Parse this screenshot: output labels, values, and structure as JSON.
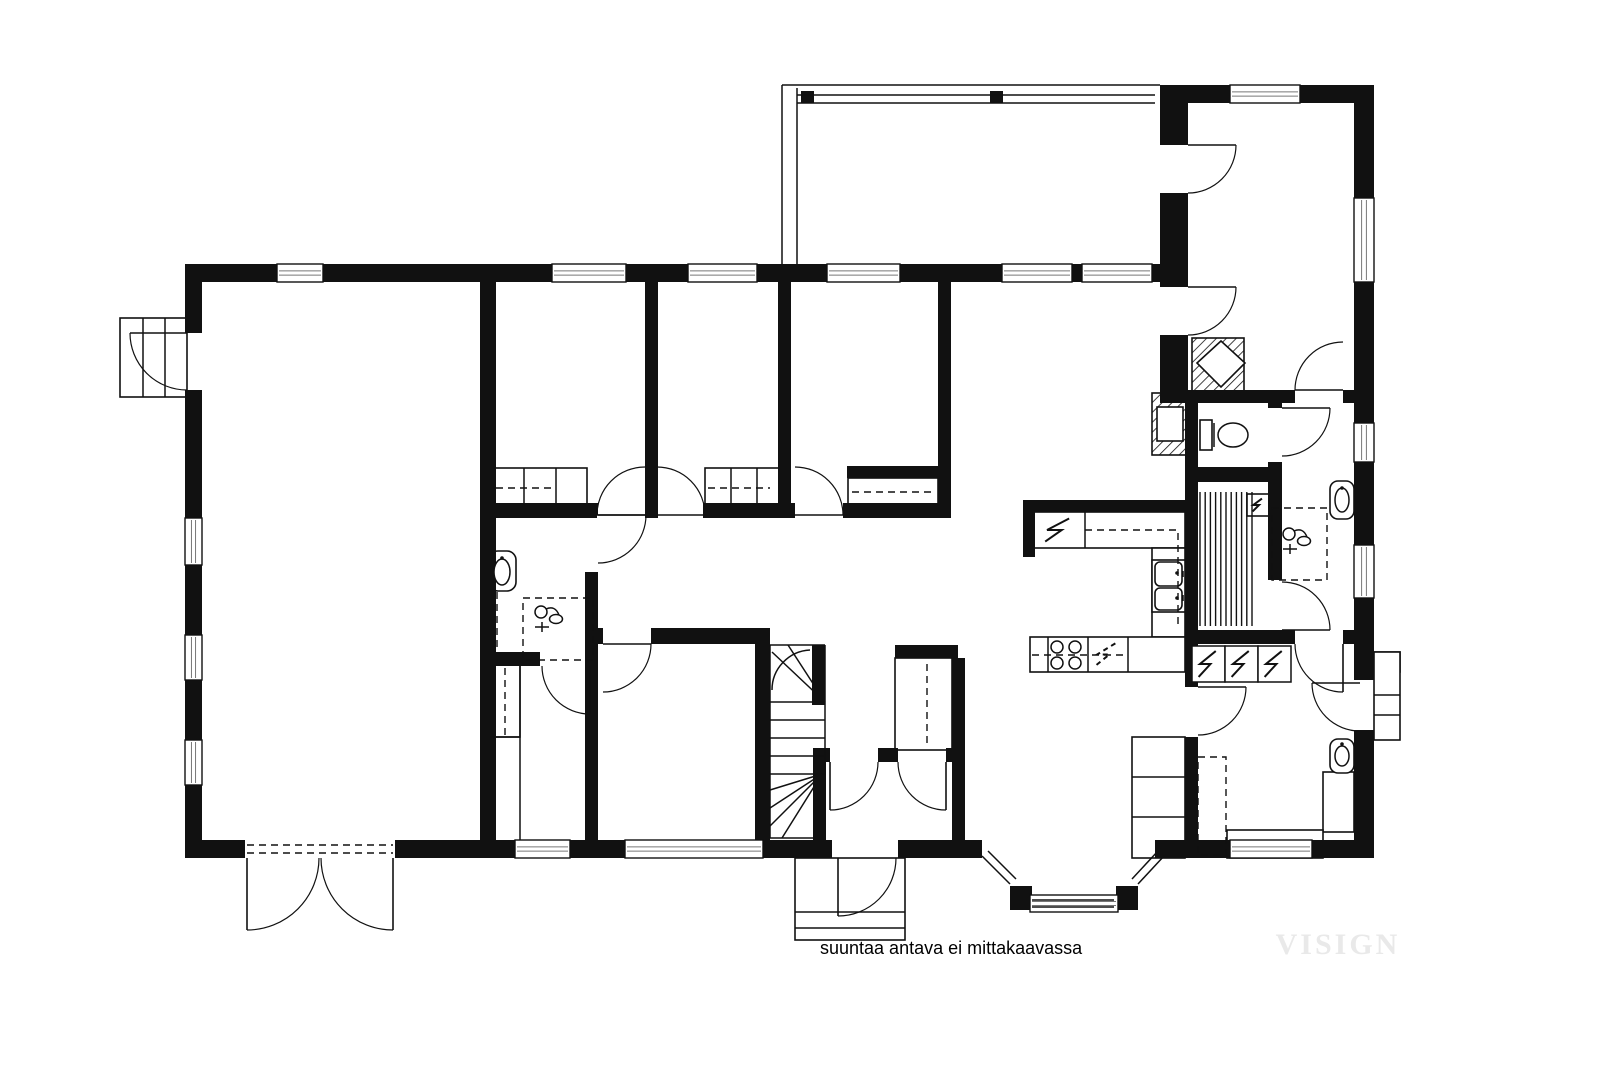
{
  "caption": {
    "text": "suuntaa antava ei mittakaavassa"
  },
  "watermark": {
    "text": "VISIGN"
  },
  "colors": {
    "ink": "#111111",
    "glass": "#777777",
    "gray_bar": "#999999",
    "watermark": "#e9e9e9",
    "bg": "#ffffff"
  },
  "canvas": {
    "width": 1600,
    "height": 1067
  },
  "plan": {
    "walls": [
      [
        185,
        264,
        92,
        18
      ],
      [
        323,
        264,
        229,
        18
      ],
      [
        626,
        264,
        62,
        18
      ],
      [
        757,
        264,
        70,
        18
      ],
      [
        900,
        264,
        102,
        18
      ],
      [
        1072,
        264,
        10,
        18
      ],
      [
        1152,
        264,
        36,
        18
      ],
      [
        1160,
        85,
        70,
        18
      ],
      [
        1300,
        85,
        74,
        18
      ],
      [
        185,
        264,
        17,
        69
      ],
      [
        185,
        390,
        17,
        128
      ],
      [
        185,
        565,
        17,
        70
      ],
      [
        185,
        680,
        17,
        60
      ],
      [
        185,
        785,
        17,
        73
      ],
      [
        185,
        840,
        60,
        18
      ],
      [
        395,
        840,
        120,
        18
      ],
      [
        570,
        840,
        55,
        18
      ],
      [
        763,
        840,
        69,
        18
      ],
      [
        898,
        840,
        84,
        18
      ],
      [
        1155,
        840,
        75,
        18
      ],
      [
        1312,
        840,
        62,
        18
      ],
      [
        1354,
        85,
        20,
        113
      ],
      [
        1354,
        282,
        20,
        141
      ],
      [
        1354,
        462,
        20,
        83
      ],
      [
        1354,
        598,
        20,
        82
      ],
      [
        1354,
        730,
        20,
        128
      ],
      [
        1160,
        85,
        28,
        60
      ],
      [
        1160,
        193,
        28,
        94
      ],
      [
        1160,
        335,
        28,
        68
      ],
      [
        1185,
        395,
        13,
        292
      ],
      [
        1185,
        737,
        13,
        121
      ],
      [
        1188,
        390,
        107,
        13
      ],
      [
        1343,
        390,
        31,
        13
      ],
      [
        1268,
        390,
        14,
        18
      ],
      [
        1268,
        462,
        14,
        18
      ],
      [
        1198,
        467,
        84,
        15
      ],
      [
        1268,
        480,
        14,
        100
      ],
      [
        1198,
        630,
        70,
        14
      ],
      [
        1268,
        630,
        27,
        14
      ],
      [
        1343,
        630,
        31,
        14
      ],
      [
        480,
        282,
        16,
        576
      ],
      [
        645,
        282,
        13,
        236
      ],
      [
        778,
        282,
        13,
        236
      ],
      [
        938,
        282,
        13,
        236
      ],
      [
        480,
        503,
        117,
        15
      ],
      [
        645,
        503,
        12,
        15
      ],
      [
        703,
        503,
        92,
        15
      ],
      [
        843,
        503,
        108,
        15
      ],
      [
        847,
        466,
        93,
        12
      ],
      [
        585,
        503,
        13,
        12
      ],
      [
        585,
        572,
        13,
        83
      ],
      [
        480,
        652,
        60,
        14
      ],
      [
        590,
        652,
        8,
        14
      ],
      [
        585,
        652,
        13,
        206
      ],
      [
        598,
        628,
        5,
        16
      ],
      [
        651,
        628,
        117,
        16
      ],
      [
        755,
        628,
        15,
        230
      ],
      [
        812,
        645,
        13,
        60
      ],
      [
        813,
        748,
        13,
        110
      ],
      [
        895,
        645,
        63,
        13
      ],
      [
        952,
        658,
        13,
        200
      ],
      [
        822,
        748,
        8,
        14
      ],
      [
        878,
        748,
        20,
        14
      ],
      [
        946,
        748,
        12,
        14
      ],
      [
        1023,
        500,
        165,
        12
      ],
      [
        1023,
        500,
        12,
        57
      ],
      [
        801,
        91,
        13,
        12
      ],
      [
        990,
        91,
        13,
        12
      ],
      [
        1010,
        886,
        22,
        24
      ],
      [
        1116,
        886,
        22,
        24
      ]
    ],
    "windows": [
      [
        277,
        264,
        46,
        18,
        "h"
      ],
      [
        552,
        264,
        74,
        18,
        "h"
      ],
      [
        688,
        264,
        69,
        18,
        "h"
      ],
      [
        827,
        264,
        73,
        18,
        "h"
      ],
      [
        1002,
        264,
        70,
        18,
        "h"
      ],
      [
        1082,
        264,
        70,
        18,
        "h"
      ],
      [
        1230,
        85,
        70,
        18,
        "h"
      ],
      [
        515,
        840,
        55,
        18,
        "h"
      ],
      [
        625,
        840,
        138,
        18,
        "h"
      ],
      [
        1230,
        840,
        82,
        18,
        "h"
      ],
      [
        185,
        518,
        17,
        47,
        "v"
      ],
      [
        185,
        635,
        17,
        45,
        "v"
      ],
      [
        185,
        740,
        17,
        45,
        "v"
      ],
      [
        1354,
        198,
        20,
        84,
        "v"
      ],
      [
        1354,
        423,
        20,
        39,
        "v"
      ],
      [
        1354,
        545,
        20,
        53,
        "v"
      ],
      [
        1030,
        895,
        88,
        17,
        "h"
      ]
    ],
    "doors": [
      [
        187,
        333,
        130,
        333,
        187,
        390,
        0
      ],
      [
        247,
        858,
        247,
        930,
        319,
        858,
        0
      ],
      [
        393,
        858,
        393,
        930,
        321,
        858,
        1
      ],
      [
        838,
        858,
        838,
        916,
        896,
        858,
        0
      ],
      [
        830,
        762,
        830,
        810,
        878,
        762,
        0
      ],
      [
        946,
        762,
        946,
        810,
        898,
        762,
        1
      ],
      [
        590,
        666,
        590,
        714,
        542,
        666,
        1
      ],
      [
        598,
        515,
        646,
        515,
        598,
        563,
        1
      ],
      [
        645,
        515,
        597,
        515,
        645,
        467,
        1
      ],
      [
        657,
        515,
        705,
        515,
        657,
        467,
        0
      ],
      [
        795,
        515,
        843,
        515,
        795,
        467,
        0
      ],
      [
        603,
        644,
        651,
        644,
        603,
        692,
        1
      ],
      [
        1188,
        145,
        1236,
        145,
        1188,
        193,
        1
      ],
      [
        1188,
        287,
        1236,
        287,
        1188,
        335,
        1
      ],
      [
        1343,
        390,
        1295,
        390,
        1343,
        342,
        1
      ],
      [
        1282,
        408,
        1330,
        408,
        1282,
        456,
        1
      ],
      [
        1282,
        630,
        1330,
        630,
        1282,
        582,
        0
      ],
      [
        1198,
        687,
        1246,
        687,
        1198,
        735,
        1
      ],
      [
        1343,
        644,
        1343,
        692,
        1295,
        644,
        1
      ],
      [
        1360,
        683,
        1312,
        683,
        1360,
        731,
        0
      ]
    ],
    "rects": [
      [
        120,
        318,
        67,
        79
      ],
      [
        795,
        858,
        110,
        82
      ],
      [
        1374,
        652,
        26,
        88
      ],
      [
        492,
        468,
        95,
        37
      ],
      [
        705,
        468,
        77,
        37
      ],
      [
        848,
        478,
        90,
        28
      ],
      [
        490,
        665,
        30,
        72
      ],
      [
        895,
        658,
        57,
        92
      ],
      [
        1028,
        512,
        157,
        36
      ],
      [
        1152,
        548,
        33,
        89
      ],
      [
        1030,
        637,
        155,
        35
      ],
      [
        1132,
        737,
        53,
        121
      ],
      [
        1323,
        772,
        31,
        60
      ],
      [
        1227,
        830,
        96,
        28
      ],
      [
        1152,
        560,
        33,
        52
      ],
      [
        1157,
        407,
        26,
        34
      ],
      [
        1200,
        420,
        12,
        30
      ],
      [
        1247,
        494,
        22,
        22
      ]
    ],
    "roundrects": [
      [
        489,
        551,
        27,
        40,
        9
      ],
      [
        1330,
        481,
        24,
        38,
        8
      ],
      [
        1330,
        739,
        24,
        34,
        8
      ],
      [
        1155,
        562,
        27,
        24,
        5
      ],
      [
        1155,
        588,
        27,
        22,
        5
      ]
    ],
    "polys": [
      [
        1197,
        363,
        1221,
        341,
        1245,
        363,
        1221,
        387
      ]
    ],
    "hatches": [
      [
        1192,
        338,
        52,
        54
      ],
      [
        1152,
        393,
        38,
        62
      ],
      [
        1374,
        652,
        26,
        20
      ]
    ],
    "lines": [
      [
        782,
        85,
        1160,
        85
      ],
      [
        782,
        85,
        782,
        264
      ],
      [
        797,
        88,
        797,
        264
      ],
      [
        797,
        95,
        1155,
        95
      ],
      [
        797,
        103,
        1155,
        103
      ],
      [
        143,
        318,
        143,
        397
      ],
      [
        165,
        318,
        165,
        397
      ],
      [
        795,
        912,
        905,
        912
      ],
      [
        795,
        928,
        905,
        928
      ],
      [
        1374,
        695,
        1400,
        695
      ],
      [
        1374,
        715,
        1400,
        715
      ],
      [
        524,
        468,
        524,
        505
      ],
      [
        556,
        468,
        556,
        505
      ],
      [
        731,
        468,
        731,
        505
      ],
      [
        757,
        468,
        757,
        505
      ],
      [
        520,
        665,
        520,
        840
      ],
      [
        490,
        737,
        520,
        737
      ],
      [
        1085,
        512,
        1085,
        548
      ],
      [
        1048,
        637,
        1048,
        672
      ],
      [
        1088,
        637,
        1088,
        672
      ],
      [
        1128,
        637,
        1128,
        672
      ],
      [
        1132,
        777,
        1185,
        777
      ],
      [
        1132,
        817,
        1185,
        817
      ],
      [
        1032,
        900,
        1114,
        900
      ],
      [
        1032,
        907,
        1114,
        907
      ],
      [
        982,
        856,
        1010,
        884
      ],
      [
        988,
        851,
        1016,
        879
      ],
      [
        1138,
        884,
        1164,
        856
      ],
      [
        1132,
        879,
        1158,
        851
      ],
      [
        770,
        645,
        825,
        645
      ],
      [
        770,
        645,
        770,
        838
      ],
      [
        825,
        645,
        825,
        775
      ],
      [
        825,
        702,
        772,
        652
      ],
      [
        825,
        702,
        788,
        645
      ],
      [
        770,
        702,
        825,
        702
      ],
      [
        770,
        720,
        825,
        720
      ],
      [
        770,
        738,
        825,
        738
      ],
      [
        770,
        756,
        825,
        756
      ],
      [
        770,
        774,
        825,
        774
      ],
      [
        822,
        774,
        770,
        790
      ],
      [
        822,
        774,
        770,
        808
      ],
      [
        822,
        774,
        770,
        826
      ],
      [
        822,
        774,
        782,
        838
      ],
      [
        770,
        838,
        815,
        838
      ],
      [
        1214,
        423,
        1214,
        447
      ],
      [
        1183,
        571,
        1183,
        577
      ],
      [
        1183,
        595,
        1183,
        601
      ]
    ],
    "arcs": [
      "M772,690 A40,40 0 0 1 810,650"
    ],
    "dashed_rects": [
      [
        523,
        598,
        70,
        62
      ],
      [
        1272,
        508,
        55,
        72
      ],
      [
        1198,
        757,
        28,
        98
      ]
    ],
    "dashed_lines": [
      [
        496,
        488,
        556,
        488
      ],
      [
        708,
        488,
        770,
        488
      ],
      [
        852,
        492,
        934,
        492
      ],
      [
        247,
        845,
        393,
        845
      ],
      [
        247,
        853,
        393,
        853
      ],
      [
        927,
        664,
        927,
        744
      ],
      [
        505,
        668,
        505,
        735
      ],
      [
        497,
        592,
        497,
        650
      ],
      [
        1032,
        655,
        1128,
        655
      ]
    ],
    "dashed_polys": [
      [
        1085,
        530,
        1178,
        530,
        1178,
        625
      ]
    ],
    "circles": [
      [
        1057,
        647,
        6
      ],
      [
        1075,
        647,
        6
      ],
      [
        1057,
        663,
        6
      ],
      [
        1075,
        663,
        6
      ]
    ],
    "ellipses": [
      [
        1233,
        435,
        15,
        12
      ],
      [
        502,
        572,
        8,
        13
      ],
      [
        1342,
        500,
        7,
        12
      ],
      [
        1342,
        756,
        7,
        10
      ]
    ],
    "dots": [
      [
        502,
        558
      ],
      [
        1342,
        488
      ],
      [
        1342,
        744
      ],
      [
        1177,
        573
      ],
      [
        1177,
        598
      ]
    ],
    "slats": [
      [
        1200,
        492,
        52,
        134,
        11
      ]
    ],
    "bolts": [
      [
        1036,
        514,
        46,
        32,
        0,
        0
      ],
      [
        1088,
        639,
        38,
        31,
        0,
        1
      ],
      [
        1192,
        646,
        33,
        36,
        1,
        0
      ],
      [
        1225,
        646,
        33,
        36,
        1,
        0
      ],
      [
        1258,
        646,
        33,
        36,
        1,
        0
      ],
      [
        1249,
        496,
        18,
        18,
        0,
        0
      ]
    ],
    "grays": [
      [
        896,
        506,
        42,
        7
      ]
    ],
    "mixers": [
      [
        548,
        618
      ],
      [
        1296,
        540
      ]
    ]
  }
}
